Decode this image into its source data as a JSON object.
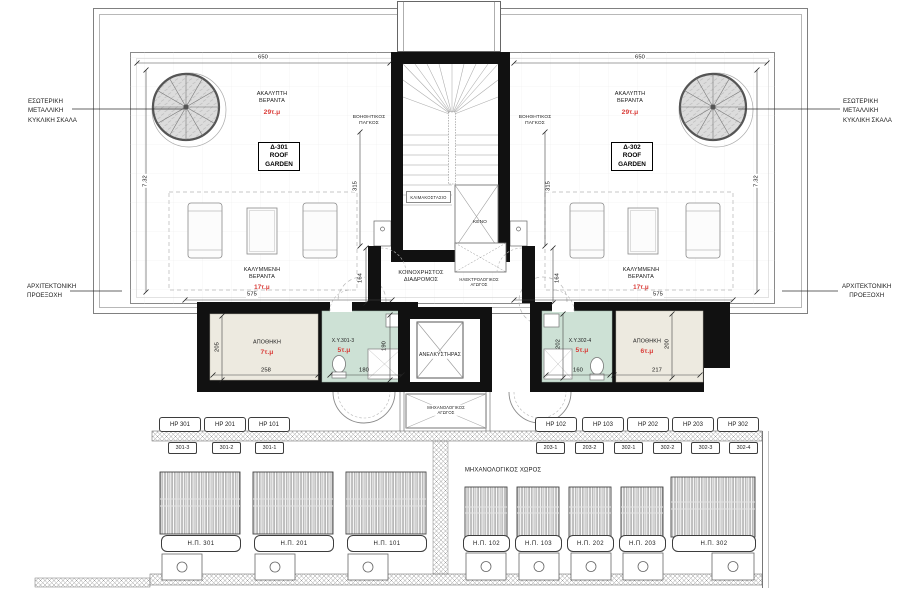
{
  "side_labels": {
    "spiral_left": "ΕΣΩΤΕΡΙΚΗ\nΜΕΤΑΛΛΙΚΗ\nΚΥΚΛΙΚΗ ΣΚΑΛΑ",
    "spiral_right": "ΕΣΩΤΕΡΙΚΗ\nΜΕΤΑΛΛΙΚΗ\nΚΥΚΛΙΚΗ ΣΚΑΛΑ",
    "projection_left": "ΑΡΧΙΤΕΚΤΟΝΙΚΗ\nΠΡΟΕΞΟΧΗ",
    "projection_right": "ΑΡΧΙΤΕΚΤΟΝΙΚΗ\nΠΡΟΕΞΟΧΗ"
  },
  "gardens": {
    "left": {
      "unit": "Δ-301\nROOF\nGARDEN",
      "terrace": "ΑΚΑΛΥΠΤΗ\nΒΕΡΑΝΤΑ",
      "terrace_area": "29τ.μ",
      "covered": "ΚΑΛΥΜΜΕΝΗ\nΒΕΡΑΝΤΑ",
      "covered_area": "17τ.μ",
      "bench": "ΒΟΗΘΗΤΙΚΟΣ\nΠΑΓΚΟΣ"
    },
    "right": {
      "unit": "Δ-302\nROOF\nGARDEN",
      "terrace": "ΑΚΑΛΥΠΤΗ\nΒΕΡΑΝΤΑ",
      "terrace_area": "29τ.μ",
      "covered": "ΚΑΛΥΜΜΕΝΗ\nΒΕΡΑΝΤΑ",
      "covered_area": "17τ.μ",
      "bench": "ΒΟΗΘΗΤΙΚΟΣ\nΠΑΓΚΟΣ"
    }
  },
  "core": {
    "stairwell": "ΚΛΙΜΑΚΟΣΤΑΣΙΟ",
    "void": "ΚΕΝΟ",
    "corridor": "ΚΟΙΝΟΧΡΗΣΤΟΣ\nΔΙΑΔΡΟΜΟΣ",
    "electrical_duct": "ΗΛΕΚΤΡΟΛΟΓΙΚΟΣ\nΑΓΩΓΟΣ",
    "elevator": "ΑΝΕΛΚΥΣΤΗΡΑΣ",
    "mechanical_duct": "ΜΗΧΑΝΟΛΟΓΙΚΟΣ\nΑΓΩΓΟΣ",
    "mechanical_room": "ΜΗΧΑΝΟΛΟΓΙΚΟΣ ΧΩΡΟΣ"
  },
  "rooms": {
    "storage_left": {
      "name": "ΑΠΟΘΗΚΗ",
      "area": "7τ.μ"
    },
    "wc_left": {
      "name": "X.Y.301-3",
      "area": "5τ.μ"
    },
    "wc_right": {
      "name": "X.Y.302-4",
      "area": "5τ.μ"
    },
    "storage_right": {
      "name": "ΑΠΟΘΗΚΗ",
      "area": "6τ.μ"
    }
  },
  "dims": {
    "roof_width_left": "650",
    "roof_width_right": "650",
    "roof_depth_left": "7.32",
    "roof_depth_right": "7.32",
    "terrace_left": "315",
    "terrace_right": "315",
    "corridor_left": "164",
    "corridor_right": "164",
    "covered_left": "575",
    "covered_right": "575",
    "storage_l_h": "205",
    "storage_l_w": "258",
    "wc_l_w": "180",
    "wc_l_h": "190",
    "wc_r_h": "202",
    "wc_r_w": "160",
    "storage_r_w": "217",
    "storage_r_h": "200"
  },
  "tags": {
    "hp": [
      "HP 301",
      "HP 201",
      "HP 101",
      "HP 102",
      "HP 103",
      "HP 202",
      "HP 203",
      "HP 302"
    ],
    "units": [
      "301-3",
      "301-2",
      "301-1",
      "203-1",
      "203-2",
      "302-1",
      "302-2",
      "302-3",
      "302-4"
    ],
    "pergolas": [
      "Η.Π. 301",
      "Η.Π. 201",
      "Η.Π. 101",
      "Η.Π. 102",
      "Η.Π. 103",
      "Η.Π. 202",
      "Η.Π. 203",
      "Η.Π. 302"
    ]
  },
  "colors": {
    "area_red": "#d93a36",
    "wc_fill": "#cde1d5",
    "storage_fill": "#edeae0",
    "wall": "#111111"
  }
}
